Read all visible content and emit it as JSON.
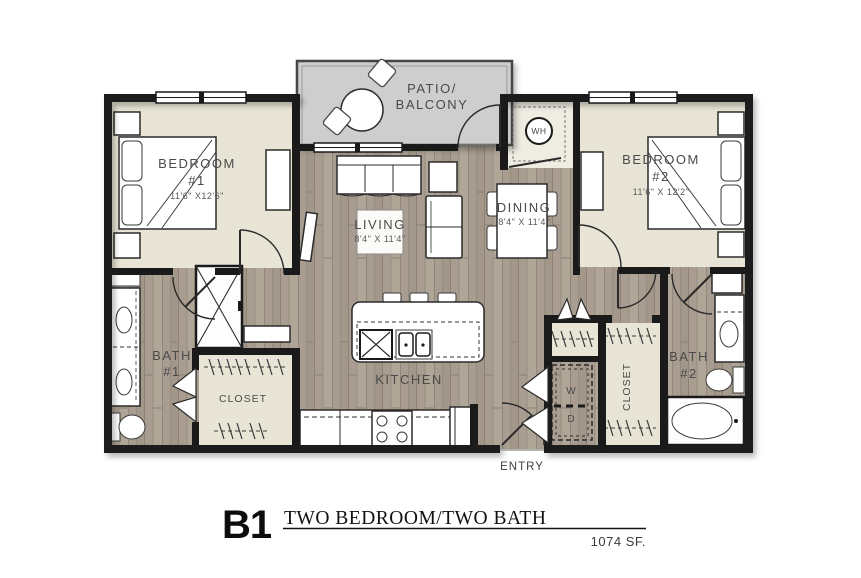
{
  "plan": {
    "code": "B1",
    "name": "TWO BEDROOM/TWO BATH",
    "area": "1074 SF."
  },
  "rooms": {
    "patio": {
      "line1": "PATIO/",
      "line2": "BALCONY"
    },
    "bedroom1": {
      "line1": "BEDROOM",
      "line2": "#1",
      "dims": "11'6\" X12'6\""
    },
    "bedroom2": {
      "line1": "BEDROOM",
      "line2": "#2",
      "dims": "11'6\" X 12'2\""
    },
    "living": {
      "label": "LIVING",
      "dims": "8'4\" X 11'4\""
    },
    "dining": {
      "label": "DINING",
      "dims": "8'4\" X 11'4\""
    },
    "kitchen": {
      "label": "KITCHEN"
    },
    "bath1": {
      "line1": "BATH",
      "line2": "#1"
    },
    "bath2": {
      "line1": "BATH",
      "line2": "#2"
    },
    "closet1": {
      "label": "CLOSET"
    },
    "closet2": {
      "label": "CLOSET"
    },
    "entry": {
      "label": "ENTRY"
    },
    "water_heater": {
      "label": "WH"
    },
    "washer": {
      "label": "W"
    },
    "dryer": {
      "label": "D"
    }
  },
  "colors": {
    "wall": "#1a1a1a",
    "wood_floor": "#a89d91",
    "bedroom_floor": "#e9e5d6",
    "patio_floor": "#cecece",
    "label_text": "#4a4a4a"
  }
}
